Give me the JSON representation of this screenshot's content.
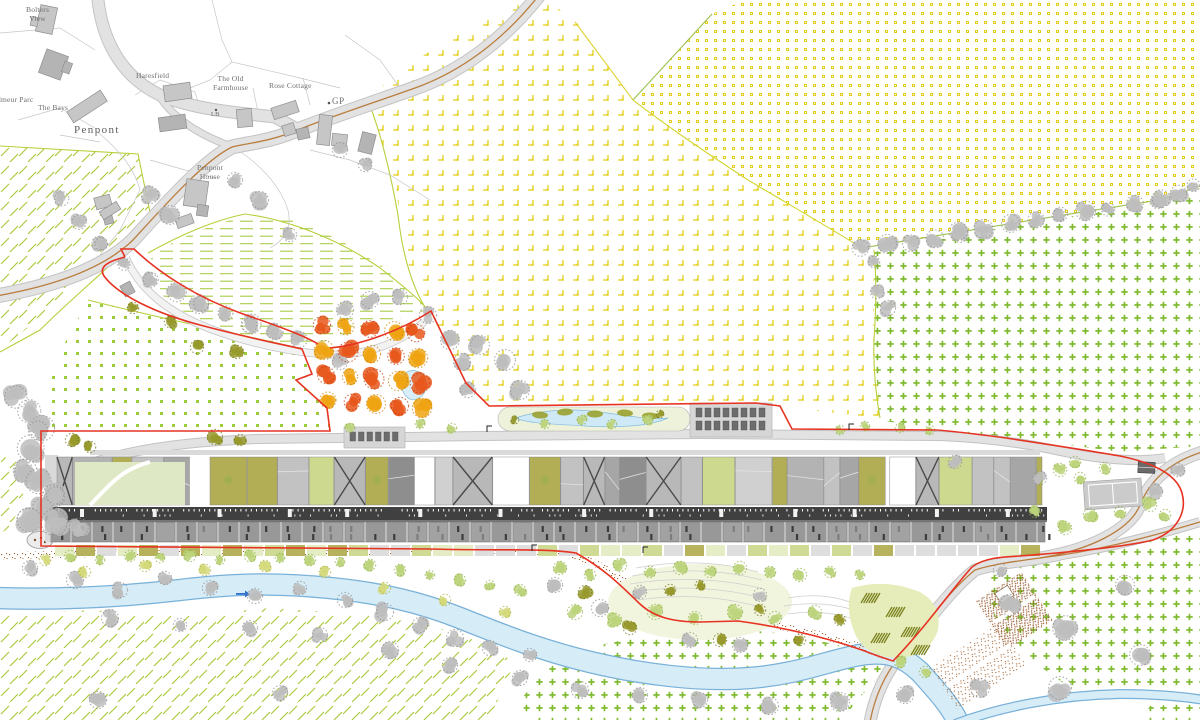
{
  "labels": {
    "bolters_view_1": "Bolters",
    "bolters_view_2": "View",
    "parc": "dmeur Parc",
    "the_bays": "The Bays",
    "penpont": "Penpont",
    "haresfield": "Haresfield",
    "old_farmhouse_1": "The Old",
    "old_farmhouse_2": "Farmhouse",
    "rose_cottage": "Rose Cottage",
    "gp": "GP",
    "lb": "LB",
    "penpont_house_1": "Penpont",
    "penpont_house_2": "House"
  },
  "colors": {
    "boundary_red": "#e63322",
    "river_fill": "#d6ecf7",
    "river_edge": "#79b1d8",
    "road_fill": "#e2e2e2",
    "road_edge": "#c3c3c3",
    "road_centerline_brown": "#b97d3e",
    "path_stipple_brown": "#a2612e",
    "field_symbol_yellow": "#e3cf1b",
    "field_symbol_green": "#7fb92e",
    "field_line_green": "#b8cf3a",
    "tree_gray": "#b5b5b5",
    "tree_green_light": "#bcd47b",
    "tree_olive": "#96992c",
    "tree_yellow_green": "#d3d97a",
    "orchard_orange": "#e7571b",
    "orchard_gold": "#eea312",
    "building_roof_light": "#c6c6c6",
    "building_spine_dark": "#404040",
    "building_terrace_gray": "#989898",
    "courtyard_olive": "#b2ae55",
    "courtyard_green": "#ccd98f",
    "water_pond": "#cfe9f6",
    "label_gray": "#6e6e6e",
    "flow_arrow_blue": "#2f6fd0"
  }
}
